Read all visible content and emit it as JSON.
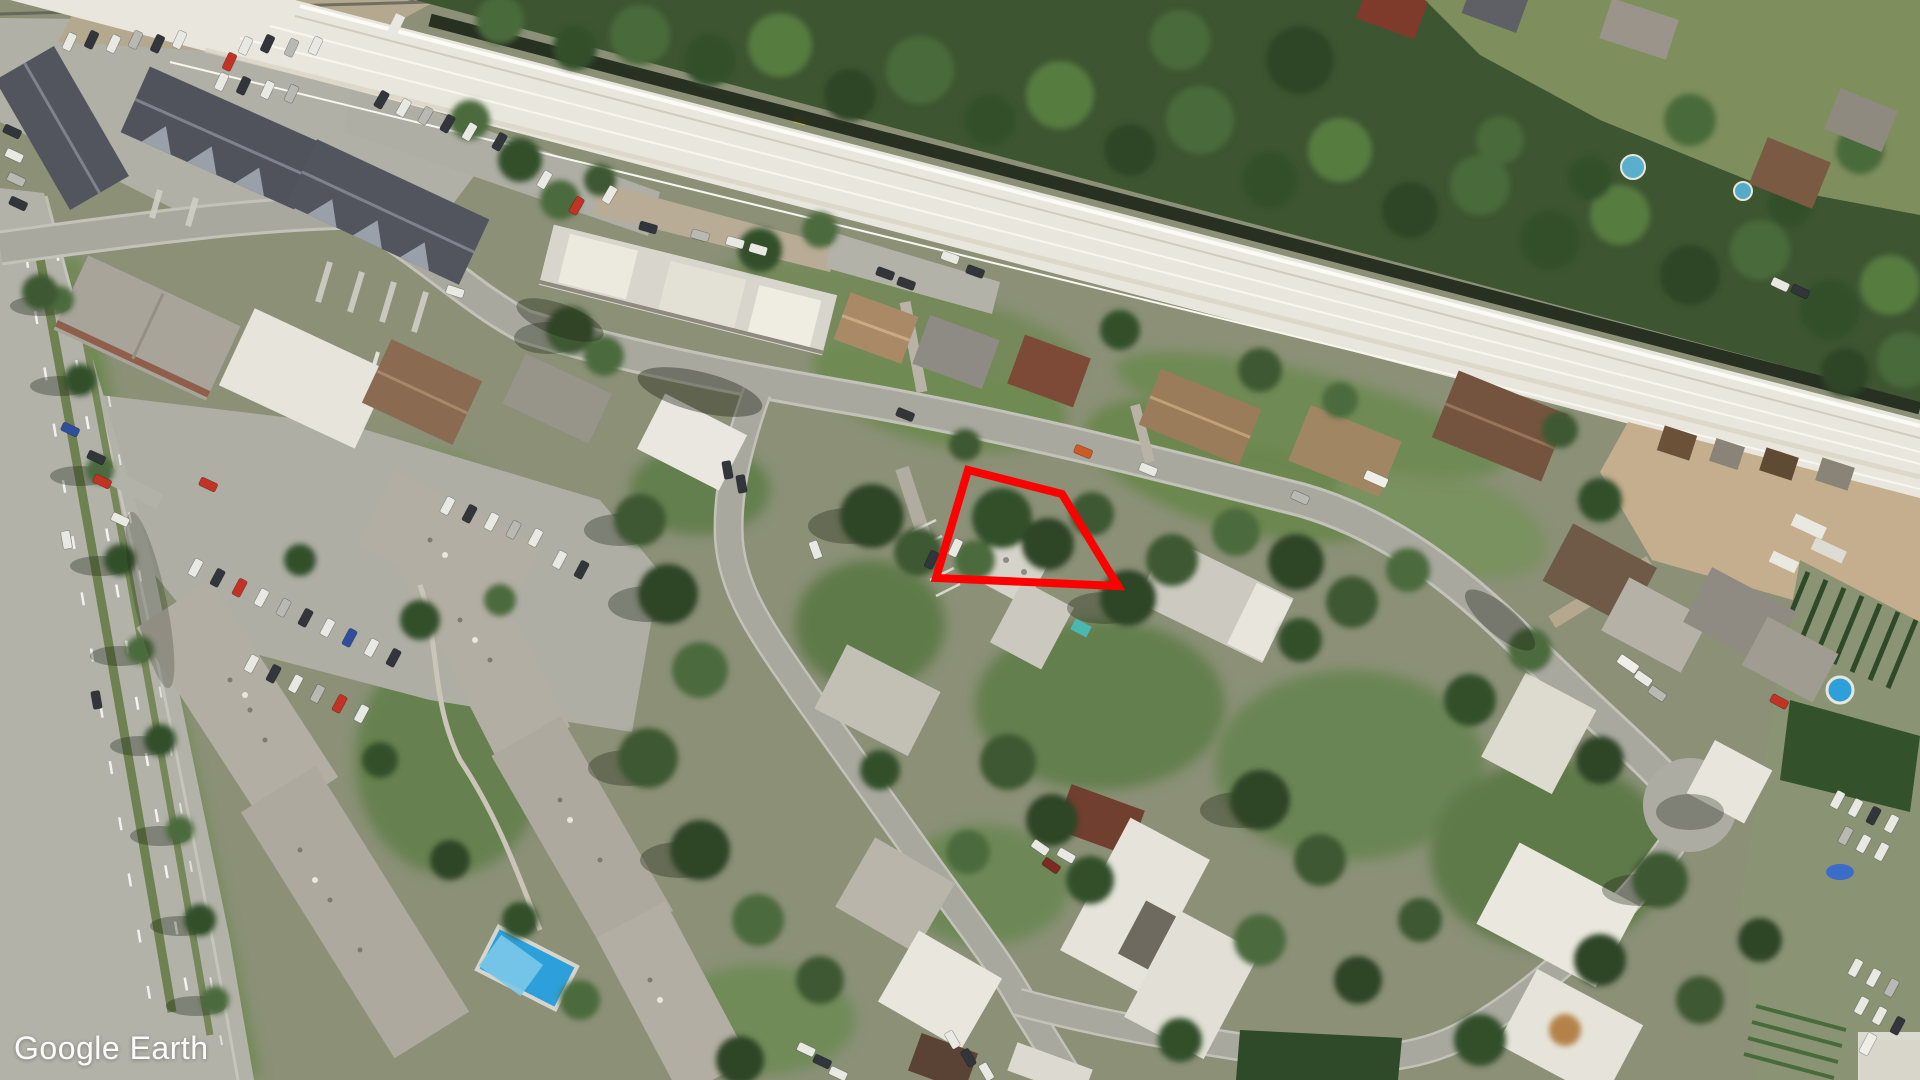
{
  "app": {
    "name": "Google Earth"
  },
  "watermark": {
    "text": "Google Earth",
    "color": "#ffffff"
  },
  "overlay": {
    "name": "property-boundary",
    "shape": "quadrilateral",
    "polygon_points": "968,470 1062,494 1118,586 936,578",
    "stroke_color": "#ff0000",
    "stroke_width": "8"
  },
  "imagery": {
    "kind": "aerial-satellite-photo",
    "palette": {
      "road": "#a8a89f",
      "avenue": "#b2b2a9",
      "grass": "#6f8a52",
      "forest": "#3d5531",
      "rail_corridor": "#e9e7dd",
      "dirt_yard": "#c4ae8d",
      "dark_roof": "#52555d",
      "white_roof": "#e8e6dd",
      "brown_roof": "#8a6a50",
      "pool_blue": "#2da0dc"
    }
  }
}
